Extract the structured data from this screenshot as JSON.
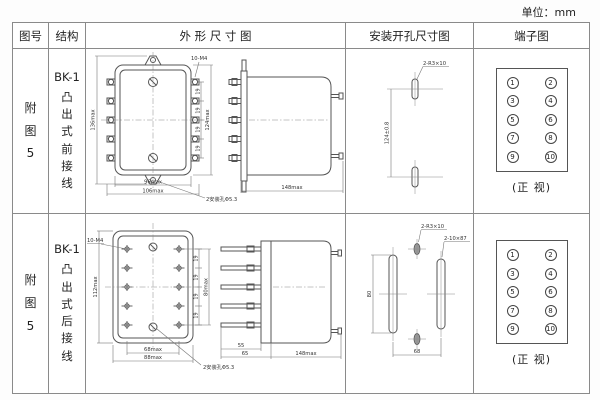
{
  "unit_label": "单位：mm",
  "colors": {
    "border": "#8a8a8a",
    "line": "#555555",
    "dim_line": "#777777",
    "text": "#333333"
  },
  "headers": {
    "fig_no": "图号",
    "structure": "结构",
    "outline": "外 形 尺 寸 图",
    "mounting": "安装开孔尺寸图",
    "terminal": "端子图"
  },
  "rows": [
    {
      "fig_chars": [
        "附",
        "图",
        "5"
      ],
      "model": "BK-1",
      "structure_chars": [
        "凸",
        "出",
        "式",
        "前",
        "接",
        "线"
      ],
      "front": {
        "height": "136max",
        "thread": "10-M4",
        "pitch": "19",
        "right_height": "124max",
        "width_inner": "96max",
        "width_outer": "106max",
        "mount_hole": "2安装孔Φ5.3"
      },
      "side": {
        "length": "148max"
      },
      "mount": {
        "slot_label": "2-R3×10",
        "spacing": "124±0.8"
      },
      "terminal_caption": "(正 视)"
    },
    {
      "fig_chars": [
        "附",
        "图",
        "5"
      ],
      "model": "BK-1",
      "structure_chars": [
        "凸",
        "出",
        "式",
        "后",
        "接",
        "线"
      ],
      "front": {
        "thread": "10-M4",
        "height": "112max",
        "pitch": "19",
        "right_height": "80max",
        "width_inner": "68max",
        "width_outer": "88max",
        "mount_hole": "2安装孔Φ5.3"
      },
      "side": {
        "stud_len": "55",
        "offset": "65",
        "length": "148max"
      },
      "mount": {
        "slot_label": "2-R3×10",
        "slot2_label": "2-10×87",
        "height": "80",
        "width": "68"
      },
      "terminal_caption": "(正 视)"
    }
  ],
  "terminals": {
    "numbers": [
      "1",
      "2",
      "3",
      "4",
      "5",
      "6",
      "7",
      "8",
      "9",
      "10"
    ]
  }
}
